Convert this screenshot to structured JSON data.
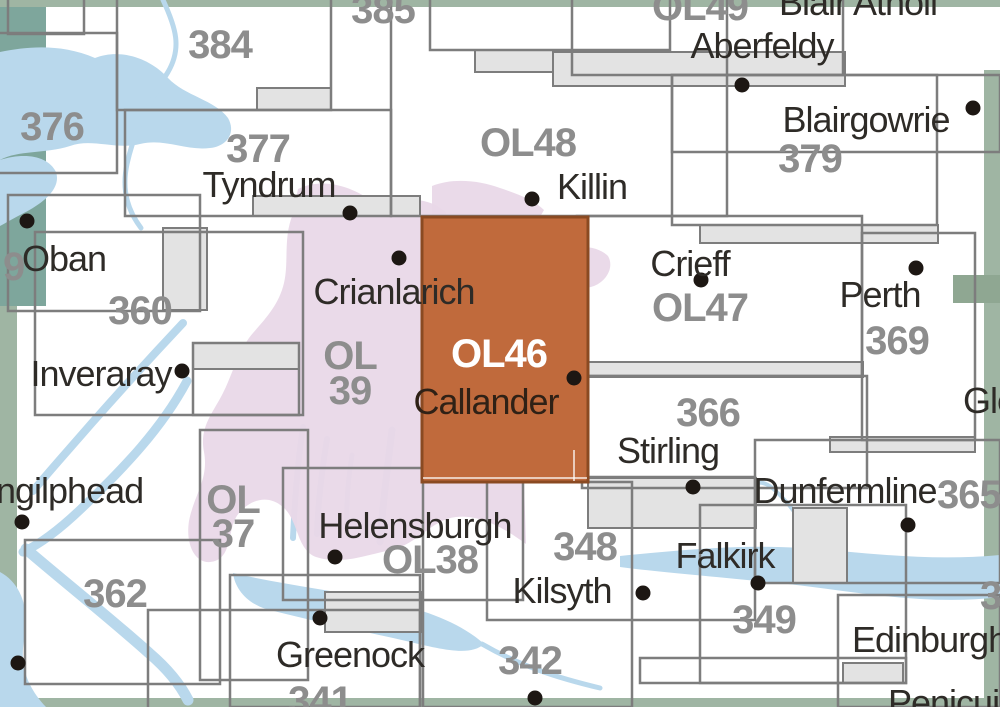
{
  "map": {
    "description": "Ordnance Survey sheet index map, central Scotland, sheet OL46 (Callander) highlighted",
    "selected_sheet": "OL46",
    "colors": {
      "background": "#ffffff",
      "outline": "#7d7d7d",
      "tab_fill": "#e3e3e3",
      "water": "#b9d8ec",
      "park": "#e9d8e8",
      "edge_green": "#9fb5a3",
      "edge_teal": "#7ea69c",
      "edge_tab": "#8fa792",
      "highlight": "#c06a3c",
      "highlight_border": "#8a4a22",
      "number_text": "#8d8d8d",
      "place_text": "#2e2b27",
      "highlight_number_text": "#ffffff",
      "highlight_place_text": "#2f2116",
      "dot": "#1d1713"
    },
    "edge_strips": [
      {
        "name": "edge-teal-topleft",
        "x": 0,
        "y": 0,
        "w": 46,
        "h": 306,
        "color": "#7ea69c"
      },
      {
        "name": "edge-left",
        "x": 0,
        "y": 306,
        "w": 17,
        "h": 401,
        "color": "#9fb5a3"
      },
      {
        "name": "edge-top",
        "x": 0,
        "y": 0,
        "w": 1000,
        "h": 7,
        "color": "#9fb5a3"
      },
      {
        "name": "edge-bottom",
        "x": 0,
        "y": 698,
        "w": 1000,
        "h": 9,
        "color": "#9fb5a3"
      },
      {
        "name": "edge-right",
        "x": 984,
        "y": 70,
        "w": 16,
        "h": 637,
        "color": "#9fb5a3"
      },
      {
        "name": "edge-right-tab",
        "x": 953,
        "y": 275,
        "w": 47,
        "h": 28,
        "color": "#8fa792"
      }
    ],
    "water": [
      {
        "name": "sea-loch-topleft",
        "kind": "fill",
        "d": "M0,52 C30,46 62,44 95,58 C120,48 150,58 168,78 C185,96 215,100 228,118 C236,132 228,146 210,148 C185,151 165,138 140,144 C115,150 92,138 70,146 C45,154 18,150 0,160 Z"
      },
      {
        "name": "sea-loch-arm",
        "kind": "fill",
        "d": "M0,160 C25,152 48,156 56,172 C62,190 40,205 22,214 C12,219 4,224 0,226 Z"
      },
      {
        "name": "river-377",
        "kind": "stroke",
        "width": 5,
        "d": "M163,0 C176,28 182,48 168,72 C148,104 134,132 127,164 C121,192 129,212 141,228"
      },
      {
        "name": "loch-awe",
        "kind": "stroke",
        "width": 8,
        "d": "M183,323 C152,356 121,390 91,424 C72,446 52,468 33,491"
      },
      {
        "name": "loch-fyne",
        "kind": "stroke",
        "width": 9,
        "d": "M187,381 C162,428 124,468 82,508 C58,531 38,545 23,552"
      },
      {
        "name": "loch-fyne-sound",
        "kind": "stroke",
        "width": 11,
        "d": "M26,549 C62,580 110,618 149,653 C170,671 181,686 188,700"
      },
      {
        "name": "sw-sea",
        "kind": "fill",
        "d": "M0,572 C22,584 30,610 24,641 C19,669 30,690 46,707 L0,707 Z"
      },
      {
        "name": "gare-loch",
        "kind": "stroke",
        "width": 6,
        "d": "M303,427 C298,460 295,494 293,538"
      },
      {
        "name": "loch-long",
        "kind": "stroke",
        "width": 6,
        "d": "M327,439 C322,470 318,500 317,534"
      },
      {
        "name": "holy-loch",
        "kind": "stroke",
        "width": 5,
        "d": "M352,455 C348,480 346,504 347,527"
      },
      {
        "name": "loch-lomond",
        "kind": "stroke",
        "width": 7,
        "d": "M392,430 C388,464 383,500 380,542"
      },
      {
        "name": "clyde-estuary",
        "kind": "fill",
        "d": "M233,573 C280,584 330,590 380,600 C428,610 462,624 484,644 C470,657 440,649 406,641 C362,631 312,621 266,609 C247,603 235,589 233,573 Z"
      },
      {
        "name": "clyde-river",
        "kind": "stroke",
        "width": 5,
        "d": "M482,644 C520,666 558,678 600,688"
      },
      {
        "name": "firth-of-forth",
        "kind": "fill",
        "d": "M620,556 C680,550 742,544 802,548 C862,552 926,562 1000,555 L1000,597 C928,606 858,592 788,584 C720,577 658,572 620,567 Z"
      },
      {
        "name": "forth-meander",
        "kind": "stroke",
        "width": 4,
        "d": "M704,498 C712,487 720,498 728,489 C736,479 744,492 752,485 C764,477 776,490 789,505 C801,520 812,538 822,551"
      }
    ],
    "park_shapes": [
      {
        "name": "national-park-main",
        "d": "M298,189 C322,177 352,186 373,202 C396,196 420,198 436,205 L446,212 L446,482 L524,482 L526,544 C506,529 480,514 456,517 C431,520 418,544 391,550 C363,556 341,565 316,557 C296,549 299,521 283,507 C267,493 249,501 239,513 C227,527 233,555 215,561 C197,567 185,547 189,521 C194,495 209,479 204,452 C199,427 213,413 223,393 C233,373 239,349 253,333 C267,317 279,304 284,283 C289,262 283,237 293,214 Z"
      },
      {
        "name": "national-park-killin-tip",
        "d": "M432,186 C452,178 478,180 500,188 C518,194 534,200 544,210 L540,217 L432,217 Z"
      },
      {
        "name": "national-park-crieff-patch",
        "d": "M560,251 C578,244 598,246 608,256 C614,266 608,280 594,286 C578,292 562,286 556,274 C552,264 554,257 560,251 Z"
      }
    ],
    "tabs": [
      {
        "name": "tab-384",
        "x": 257,
        "y": 88,
        "w": 74,
        "h": 22
      },
      {
        "name": "tab-tyndrum",
        "x": 253,
        "y": 196,
        "w": 167,
        "h": 20
      },
      {
        "name": "tab-385",
        "x": 475,
        "y": 50,
        "w": 146,
        "h": 22
      },
      {
        "name": "tab-aberfeldy",
        "x": 553,
        "y": 52,
        "w": 292,
        "h": 34
      },
      {
        "name": "tab-379",
        "x": 700,
        "y": 225,
        "w": 238,
        "h": 18
      },
      {
        "name": "tab-ol47",
        "x": 495,
        "y": 362,
        "w": 368,
        "h": 15
      },
      {
        "name": "tab-369",
        "x": 830,
        "y": 437,
        "w": 145,
        "h": 15
      },
      {
        "name": "tab-stirling",
        "x": 588,
        "y": 478,
        "w": 168,
        "h": 50
      },
      {
        "name": "tab-dunfermline",
        "x": 793,
        "y": 508,
        "w": 54,
        "h": 75
      },
      {
        "name": "tab-edinburgh",
        "x": 843,
        "y": 663,
        "w": 60,
        "h": 20
      },
      {
        "name": "tab-helensburgh",
        "x": 325,
        "y": 592,
        "w": 96,
        "h": 40
      },
      {
        "name": "tab-inveraray",
        "x": 193,
        "y": 343,
        "w": 106,
        "h": 26
      },
      {
        "name": "tab-oban",
        "x": 163,
        "y": 228,
        "w": 44,
        "h": 82
      }
    ],
    "outlines": [
      {
        "name": "sheet-box-topleft-small",
        "x": 8,
        "y": -40,
        "w": 76,
        "h": 74
      },
      {
        "name": "sheet-box-376",
        "x": -60,
        "y": 33,
        "w": 177,
        "h": 140
      },
      {
        "name": "sheet-box-384",
        "x": 117,
        "y": -60,
        "w": 214,
        "h": 170
      },
      {
        "name": "sheet-box-377",
        "x": 125,
        "y": 110,
        "w": 266,
        "h": 106
      },
      {
        "name": "sheet-box-ol48",
        "x": 391,
        "y": -30,
        "w": 336,
        "h": 246
      },
      {
        "name": "sheet-box-385",
        "x": 430,
        "y": -60,
        "w": 240,
        "h": 110
      },
      {
        "name": "sheet-box-ol49",
        "x": 572,
        "y": -80,
        "w": 271,
        "h": 155
      },
      {
        "name": "sheet-box-379",
        "x": 672,
        "y": 75,
        "w": 265,
        "h": 150
      },
      {
        "name": "sheet-box-379-east",
        "x": 672,
        "y": 75,
        "w": 328,
        "h": 77
      },
      {
        "name": "sheet-box-ol47",
        "x": 577,
        "y": 216,
        "w": 285,
        "h": 160
      },
      {
        "name": "sheet-box-369",
        "x": 862,
        "y": 233,
        "w": 113,
        "h": 207
      },
      {
        "name": "sheet-box-366",
        "x": 582,
        "y": 376,
        "w": 285,
        "h": 112
      },
      {
        "name": "sheet-box-348",
        "x": 487,
        "y": 477,
        "w": 268,
        "h": 143
      },
      {
        "name": "sheet-box-349",
        "x": 700,
        "y": 505,
        "w": 206,
        "h": 178
      },
      {
        "name": "sheet-box-365",
        "x": 755,
        "y": 440,
        "w": 245,
        "h": 143
      },
      {
        "name": "sheet-box-edinburgh",
        "x": 838,
        "y": 595,
        "w": 162,
        "h": 112
      },
      {
        "name": "sheet-box-349-band",
        "x": 640,
        "y": 658,
        "w": 266,
        "h": 25
      },
      {
        "name": "sheet-box-oban",
        "x": 8,
        "y": 195,
        "w": 192,
        "h": 116
      },
      {
        "name": "sheet-box-360",
        "x": 35,
        "y": 232,
        "w": 268,
        "h": 183
      },
      {
        "name": "sheet-box-inveraray",
        "x": 193,
        "y": 343,
        "w": 106,
        "h": 72
      },
      {
        "name": "sheet-box-ol37",
        "x": 200,
        "y": 430,
        "w": 108,
        "h": 250
      },
      {
        "name": "sheet-box-362",
        "x": 25,
        "y": 540,
        "w": 195,
        "h": 144
      },
      {
        "name": "sheet-box-ol38",
        "x": 283,
        "y": 468,
        "w": 240,
        "h": 132
      },
      {
        "name": "sheet-box-greenock",
        "x": 230,
        "y": 575,
        "w": 190,
        "h": 132
      },
      {
        "name": "sheet-box-341",
        "x": 148,
        "y": 610,
        "w": 272,
        "h": 120
      },
      {
        "name": "sheet-box-342",
        "x": 423,
        "y": 482,
        "w": 209,
        "h": 225
      }
    ],
    "highlight": {
      "name": "selected-sheet-ol46",
      "x": 422,
      "y": 217,
      "w": 166,
      "h": 265
    },
    "highlight_inner_lines": [
      {
        "name": "ol46-inner-line-h",
        "x1": 423,
        "y1": 478,
        "x2": 587,
        "y2": 478
      },
      {
        "name": "ol46-inner-line-v",
        "x1": 574,
        "y1": 450,
        "x2": 574,
        "y2": 481
      }
    ],
    "dots": [
      {
        "name": "dot-tyndrum",
        "x": 350,
        "y": 213
      },
      {
        "name": "dot-killin",
        "x": 532,
        "y": 199
      },
      {
        "name": "dot-aberfeldy",
        "x": 742,
        "y": 85
      },
      {
        "name": "dot-blairgowrie",
        "x": 973,
        "y": 108
      },
      {
        "name": "dot-oban",
        "x": 27,
        "y": 221
      },
      {
        "name": "dot-crianlarich",
        "x": 399,
        "y": 258
      },
      {
        "name": "dot-crieff",
        "x": 701,
        "y": 280
      },
      {
        "name": "dot-perth",
        "x": 916,
        "y": 268
      },
      {
        "name": "dot-inveraray",
        "x": 182,
        "y": 371
      },
      {
        "name": "dot-callander",
        "x": 574,
        "y": 378
      },
      {
        "name": "dot-lochgilphead",
        "x": 22,
        "y": 522
      },
      {
        "name": "dot-stirling",
        "x": 693,
        "y": 487
      },
      {
        "name": "dot-dunfermline",
        "x": 908,
        "y": 525
      },
      {
        "name": "dot-helensburgh",
        "x": 335,
        "y": 557
      },
      {
        "name": "dot-falkirk",
        "x": 758,
        "y": 583
      },
      {
        "name": "dot-kilsyth",
        "x": 643,
        "y": 593
      },
      {
        "name": "dot-greenock",
        "x": 320,
        "y": 618
      },
      {
        "name": "dot-town-southwest",
        "x": 18,
        "y": 663
      },
      {
        "name": "dot-town-south",
        "x": 535,
        "y": 698
      }
    ],
    "labels": [
      {
        "name": "sheet-label-385",
        "text": "385",
        "kind": "number",
        "x": 383,
        "y": 10,
        "anchor": "center"
      },
      {
        "name": "sheet-label-384",
        "text": "384",
        "kind": "number",
        "x": 220,
        "y": 45,
        "anchor": "center"
      },
      {
        "name": "sheet-label-376",
        "text": "376",
        "kind": "number",
        "x": 52,
        "y": 127,
        "anchor": "center"
      },
      {
        "name": "sheet-label-377",
        "text": "377",
        "kind": "number",
        "x": 258,
        "y": 149,
        "anchor": "center"
      },
      {
        "name": "sheet-label-ol48",
        "text": "OL48",
        "kind": "number",
        "x": 528,
        "y": 143,
        "anchor": "center"
      },
      {
        "name": "sheet-label-ol49",
        "text": "OL49",
        "kind": "number",
        "x": 700,
        "y": 7,
        "anchor": "center"
      },
      {
        "name": "sheet-label-379",
        "text": "379",
        "kind": "number",
        "x": 810,
        "y": 159,
        "anchor": "center"
      },
      {
        "name": "sheet-label-ol47",
        "text": "OL47",
        "kind": "number",
        "x": 700,
        "y": 308,
        "anchor": "center"
      },
      {
        "name": "sheet-label-369",
        "text": "369",
        "kind": "number",
        "x": 897,
        "y": 341,
        "anchor": "center"
      },
      {
        "name": "sheet-label-360",
        "text": "360",
        "kind": "number",
        "x": 140,
        "y": 311,
        "anchor": "center"
      },
      {
        "name": "sheet-label-359-clipped",
        "text": "9",
        "kind": "number",
        "x": 3,
        "y": 267,
        "anchor": "left"
      },
      {
        "name": "sheet-label-ol39-line1",
        "text": "OL",
        "kind": "number",
        "x": 350,
        "y": 356,
        "anchor": "center"
      },
      {
        "name": "sheet-label-ol39-line2",
        "text": "39",
        "kind": "number",
        "x": 350,
        "y": 391,
        "anchor": "center"
      },
      {
        "name": "sheet-label-ol46",
        "text": "OL46",
        "kind": "number",
        "x": 499,
        "y": 354,
        "anchor": "center",
        "color": "#ffffff"
      },
      {
        "name": "sheet-label-366",
        "text": "366",
        "kind": "number",
        "x": 708,
        "y": 413,
        "anchor": "center"
      },
      {
        "name": "sheet-label-365-clipped",
        "text": "365",
        "kind": "number",
        "x": 937,
        "y": 495,
        "anchor": "left"
      },
      {
        "name": "sheet-label-ol37-line1",
        "text": "OL",
        "kind": "number",
        "x": 233,
        "y": 500,
        "anchor": "center"
      },
      {
        "name": "sheet-label-ol37-line2",
        "text": "37",
        "kind": "number",
        "x": 233,
        "y": 534,
        "anchor": "center"
      },
      {
        "name": "sheet-label-ol38",
        "text": "OL38",
        "kind": "number",
        "x": 430,
        "y": 560,
        "anchor": "center"
      },
      {
        "name": "sheet-label-362",
        "text": "362",
        "kind": "number",
        "x": 115,
        "y": 594,
        "anchor": "center"
      },
      {
        "name": "sheet-label-348",
        "text": "348",
        "kind": "number",
        "x": 585,
        "y": 547,
        "anchor": "center"
      },
      {
        "name": "sheet-label-349",
        "text": "349",
        "kind": "number",
        "x": 764,
        "y": 620,
        "anchor": "center"
      },
      {
        "name": "sheet-label-342",
        "text": "342",
        "kind": "number",
        "x": 530,
        "y": 661,
        "anchor": "center"
      },
      {
        "name": "sheet-label-341",
        "text": "341",
        "kind": "number",
        "x": 320,
        "y": 701,
        "anchor": "center"
      },
      {
        "name": "sheet-label-350-clipped",
        "text": "35",
        "kind": "number",
        "x": 980,
        "y": 596,
        "anchor": "left"
      },
      {
        "name": "place-label-blair-atholl",
        "text": "Blair Atholl",
        "kind": "place",
        "x": 858,
        "y": 3,
        "anchor": "center"
      },
      {
        "name": "place-label-aberfeldy",
        "text": "Aberfeldy",
        "kind": "place",
        "x": 762,
        "y": 46,
        "anchor": "center"
      },
      {
        "name": "place-label-blairgowrie",
        "text": "Blairgowrie",
        "kind": "place",
        "x": 866,
        "y": 120,
        "anchor": "center"
      },
      {
        "name": "place-label-tyndrum",
        "text": "Tyndrum",
        "kind": "place",
        "x": 269,
        "y": 185,
        "anchor": "center"
      },
      {
        "name": "place-label-killin",
        "text": "Killin",
        "kind": "place",
        "x": 592,
        "y": 187,
        "anchor": "center"
      },
      {
        "name": "place-label-oban",
        "text": "Oban",
        "kind": "place",
        "x": 64,
        "y": 259,
        "anchor": "center"
      },
      {
        "name": "place-label-crieff",
        "text": "Crieff",
        "kind": "place",
        "x": 690,
        "y": 264,
        "anchor": "center"
      },
      {
        "name": "place-label-perth",
        "text": "Perth",
        "kind": "place",
        "x": 880,
        "y": 295,
        "anchor": "center"
      },
      {
        "name": "place-label-crianlarich",
        "text": "Crianlarich",
        "kind": "place",
        "x": 394,
        "y": 292,
        "anchor": "center"
      },
      {
        "name": "place-label-inveraray",
        "text": "Inveraray",
        "kind": "place",
        "x": 101,
        "y": 374,
        "anchor": "center"
      },
      {
        "name": "place-label-callander",
        "text": "Callander",
        "kind": "place",
        "x": 486,
        "y": 402,
        "anchor": "center",
        "color": "#2f2116"
      },
      {
        "name": "place-label-stirling",
        "text": "Stirling",
        "kind": "place",
        "x": 668,
        "y": 451,
        "anchor": "center"
      },
      {
        "name": "place-label-lochgilphead-clipped",
        "text": "ngilphead",
        "kind": "place",
        "x": -4,
        "y": 491,
        "anchor": "left"
      },
      {
        "name": "place-label-dunfermline",
        "text": "Dunfermline",
        "kind": "place",
        "x": 845,
        "y": 491,
        "anchor": "center"
      },
      {
        "name": "place-label-helensburgh",
        "text": "Helensburgh",
        "kind": "place",
        "x": 415,
        "y": 526,
        "anchor": "center"
      },
      {
        "name": "place-label-falkirk",
        "text": "Falkirk",
        "kind": "place",
        "x": 725,
        "y": 556,
        "anchor": "center"
      },
      {
        "name": "place-label-kilsyth",
        "text": "Kilsyth",
        "kind": "place",
        "x": 562,
        "y": 591,
        "anchor": "center"
      },
      {
        "name": "place-label-greenock",
        "text": "Greenock",
        "kind": "place",
        "x": 350,
        "y": 655,
        "anchor": "center"
      },
      {
        "name": "place-label-edinburgh-clipped",
        "text": "Edinburgh",
        "kind": "place",
        "x": 852,
        "y": 640,
        "anchor": "left"
      },
      {
        "name": "place-label-penicuik-clipped",
        "text": "Penicuik",
        "kind": "place",
        "x": 888,
        "y": 703,
        "anchor": "left"
      },
      {
        "name": "place-label-gle-clipped",
        "text": "Gle",
        "kind": "place",
        "x": 963,
        "y": 401,
        "anchor": "left"
      }
    ]
  }
}
